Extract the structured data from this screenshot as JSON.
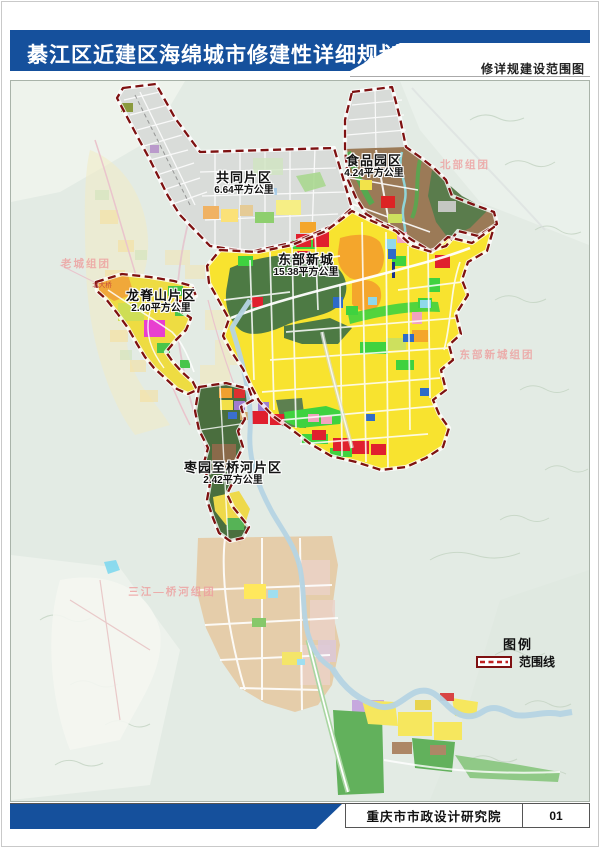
{
  "header": {
    "title": "綦江区近建区海绵城市修建性详细规划",
    "subtitle": "修详规建设范围图"
  },
  "map": {
    "districts": [
      {
        "id": "gongtong",
        "name": "共同片区",
        "area": "6.64平方公里"
      },
      {
        "id": "shipin",
        "name": "食品园区",
        "area": "4.24平方公里"
      },
      {
        "id": "dongbu",
        "name": "东部新城",
        "area": "15.38平方公里"
      },
      {
        "id": "longjishan",
        "name": "龙脊山片区",
        "area": "2.40平方公里"
      },
      {
        "id": "zaoyuan",
        "name": "枣园至桥河片区",
        "area": "2.42平方公里"
      }
    ],
    "groups": [
      {
        "id": "beibu",
        "name": "北部组团"
      },
      {
        "id": "laocheng",
        "name": "老城组团"
      },
      {
        "id": "dongbu",
        "name": "东部新城组团"
      },
      {
        "id": "sanjiang",
        "name": "三江—桥河组团"
      }
    ],
    "annotations": [
      {
        "id": "beidaqiao",
        "name": "北大桥"
      }
    ]
  },
  "legend": {
    "title": "图例",
    "items": [
      {
        "label": "范围线",
        "symbol": "boundary-line"
      }
    ]
  },
  "footer": {
    "organization": "重庆市市政设计研究院",
    "page": "01"
  },
  "colors": {
    "header_blue": "#15509c",
    "boundary_red": "#7e1111",
    "group_label_pink": "#ee9e9e",
    "map_background": "#e3ebe4",
    "residential_yellow": "#f8e32f",
    "industry_brown": "#9b7a57",
    "park_green": "#3fd23f",
    "forest_green": "#4d7a44",
    "commercial_red": "#e0202e",
    "orange": "#f4a62c"
  }
}
